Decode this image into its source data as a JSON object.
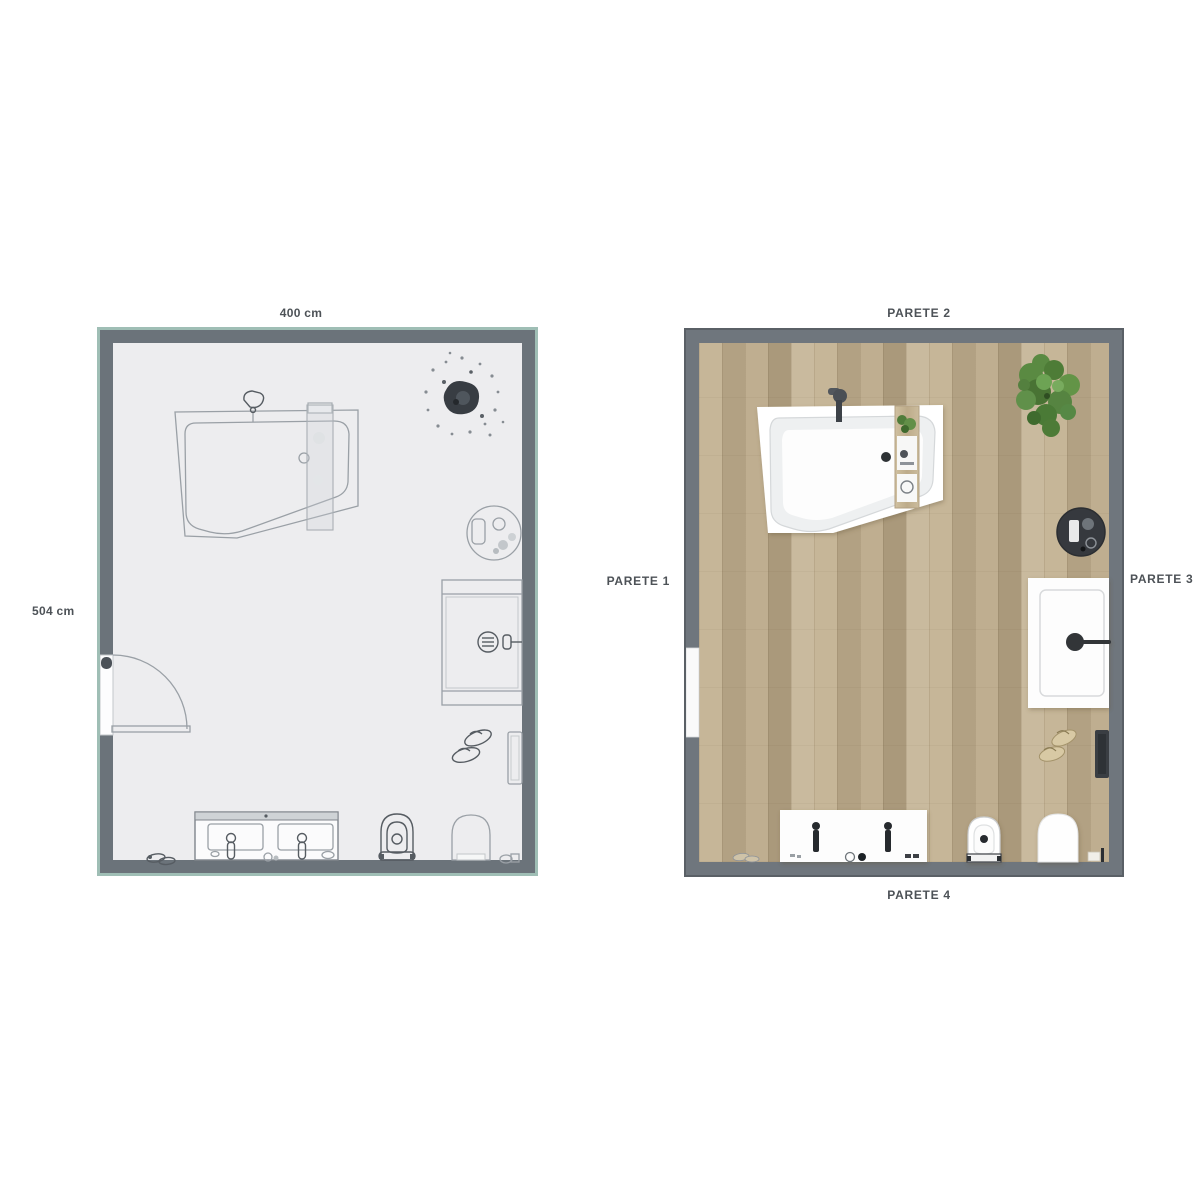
{
  "title": "bathroom-floor-plan-comparison",
  "left_plan": {
    "name": "schematic-floor-plan",
    "dimension_width_label": "400 cm",
    "dimension_height_label": "504 cm",
    "fixtures": [
      "bathtub",
      "bathtub-faucet",
      "bath-shelf",
      "potted-plant",
      "side-table",
      "shower",
      "shower-drain",
      "slippers",
      "towel",
      "door",
      "double-vanity",
      "sink-faucet",
      "bidet",
      "toilet",
      "bath-mat"
    ],
    "colors": {
      "wall": "#6b737a",
      "wall_edge": "#9fbeb5",
      "floor": "#ededef",
      "line": "#9aa0a6"
    }
  },
  "right_plan": {
    "name": "rendered-floor-plan",
    "wall_labels": {
      "left": "PARETE 1",
      "top": "PARETE 2",
      "right": "PARETE 3",
      "bottom": "PARETE 4"
    },
    "fixtures": [
      "bathtub",
      "bathtub-faucet",
      "bath-shelf",
      "potted-plant",
      "round-stool",
      "shower-mat",
      "shower-drain",
      "slippers",
      "towel",
      "door",
      "double-vanity",
      "sink-faucet",
      "bidet",
      "toilet",
      "bath-mat"
    ],
    "colors": {
      "wall": "#6f767d",
      "wall_edge": "#5a6066",
      "floor_wood": "#b9a98b",
      "plant_green": "#568441",
      "fixture_dark": "#33373c",
      "shelf_wood": "#c3b292"
    }
  }
}
